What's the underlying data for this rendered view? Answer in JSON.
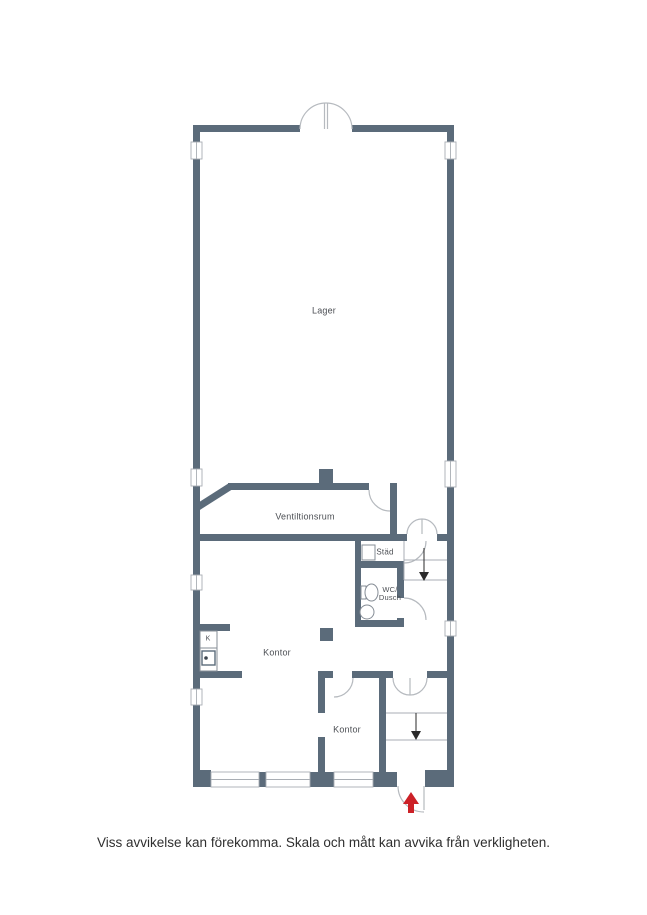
{
  "colors": {
    "wall": "#5b6b7a",
    "door_line": "#b6babf",
    "stair_line": "#a9aeb4",
    "fixture_line": "#858c95",
    "label_text": "#4c4f54",
    "entrance_arrow": "#cc2127",
    "background": "#ffffff"
  },
  "plan": {
    "rooms": {
      "lager": "Lager",
      "ventilation": "Ventiltionsrum",
      "stad": "Städ",
      "wc_line1": "WC/",
      "wc_line2": "Dusch",
      "kontor_upper": "Kontor",
      "kontor_lower": "Kontor",
      "kitchen": "K"
    }
  },
  "footer": {
    "disclaimer": "Viss avvikelse kan förekomma. Skala och mått kan avvika från verkligheten."
  }
}
